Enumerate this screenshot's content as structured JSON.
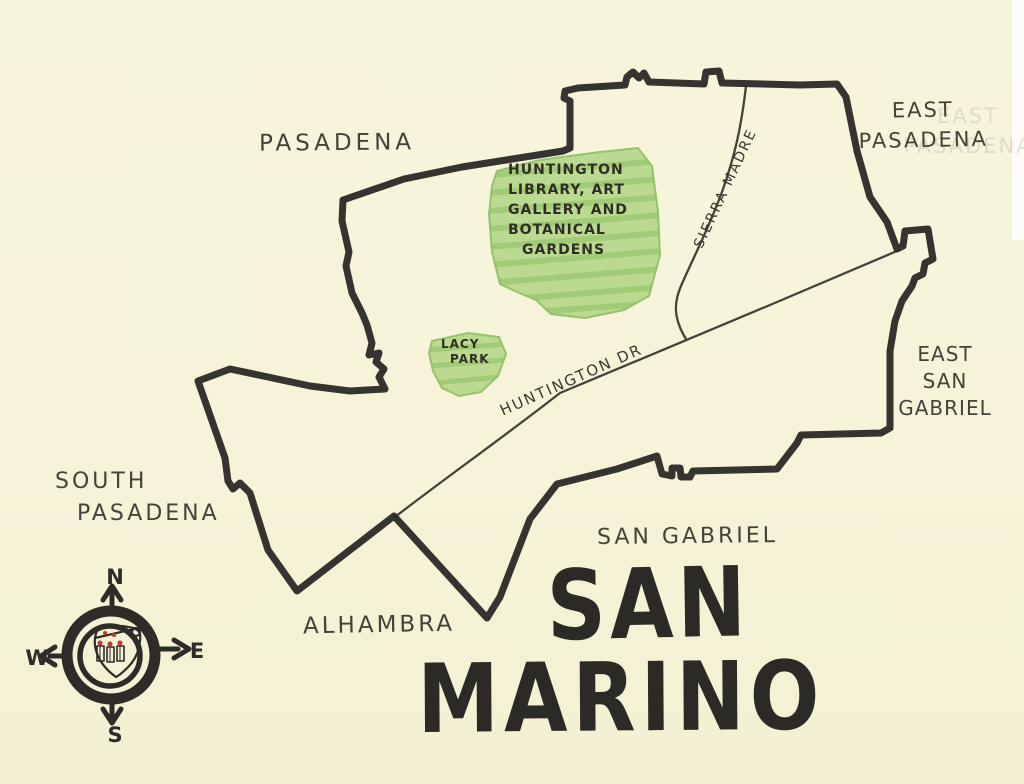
{
  "map": {
    "title": {
      "line1": "SAN",
      "line2": "MARINO"
    },
    "neighbors": {
      "pasadena": "PASADENA",
      "east_pasadena": [
        "EAST",
        "PASADENA"
      ],
      "east_san_gabriel": [
        "EAST",
        "SAN",
        "GABRIEL"
      ],
      "south_pasadena": [
        "SOUTH",
        "PASADENA"
      ],
      "alhambra": "ALHAMBRA",
      "san_gabriel": "SAN GABRIEL"
    },
    "roads": {
      "huntington_dr": "HUNTINGTON DR",
      "sierra_madre": "SIERRA MADRE"
    },
    "parks": {
      "huntington_gardens": {
        "lines": [
          "HUNTINGTON",
          "LIBRARY, ART",
          "GALLERY AND",
          "BOTANICAL",
          "GARDENS"
        ]
      },
      "lacy_park": {
        "lines": [
          "LACY",
          "PARK"
        ]
      }
    },
    "compass": {
      "north": "N",
      "east": "E",
      "south": "S",
      "west": "W"
    },
    "colors": {
      "paper": "#f6f3d8",
      "ink": "#2e2c29",
      "pencil": "#45423a",
      "park_green": "#b3d787",
      "park_green_dark": "#8abc5e",
      "crest_red": "#c03730"
    }
  }
}
